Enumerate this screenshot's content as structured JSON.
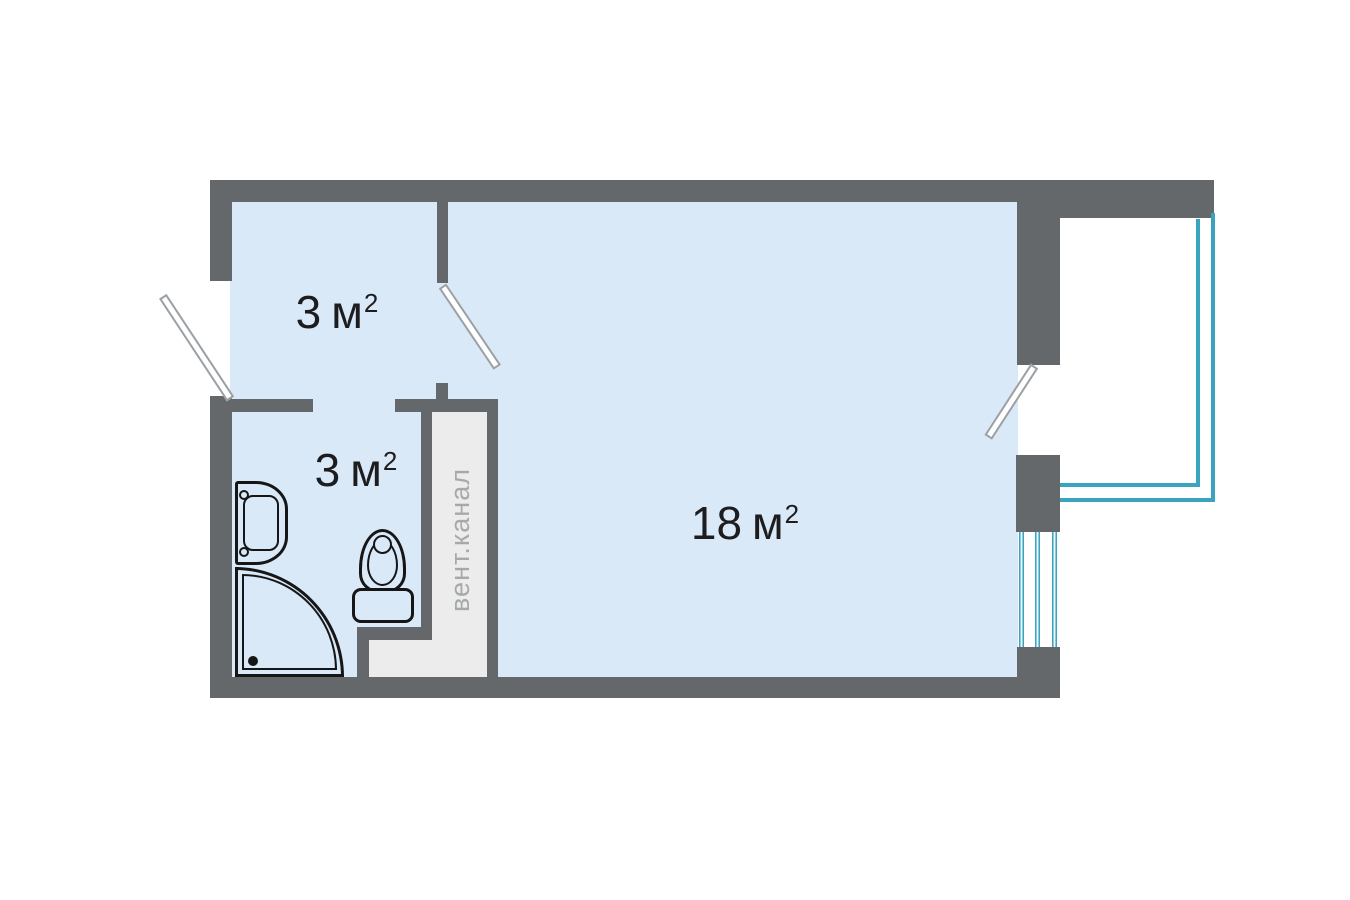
{
  "plan": {
    "rooms": [
      {
        "name": "hallway",
        "area": "3",
        "unit": "м",
        "sup": "2"
      },
      {
        "name": "bathroom",
        "area": "3",
        "unit": "м",
        "sup": "2"
      },
      {
        "name": "living-room",
        "area": "18",
        "unit": "м",
        "sup": "2"
      }
    ],
    "vent_shaft_label": "вент.канал",
    "colors": {
      "wall": "#65686b",
      "floor": "#d9e9f8",
      "shaft_fill": "#ebeceb",
      "railing": "#3aa3be",
      "window_glass": "#e9f6fa",
      "fixture_line": "#161616",
      "door_leaf_outline": "#9aa0a4",
      "label_text": "#1d1d1f",
      "vent_text": "#a6a9ac",
      "background": "#ffffff"
    }
  }
}
